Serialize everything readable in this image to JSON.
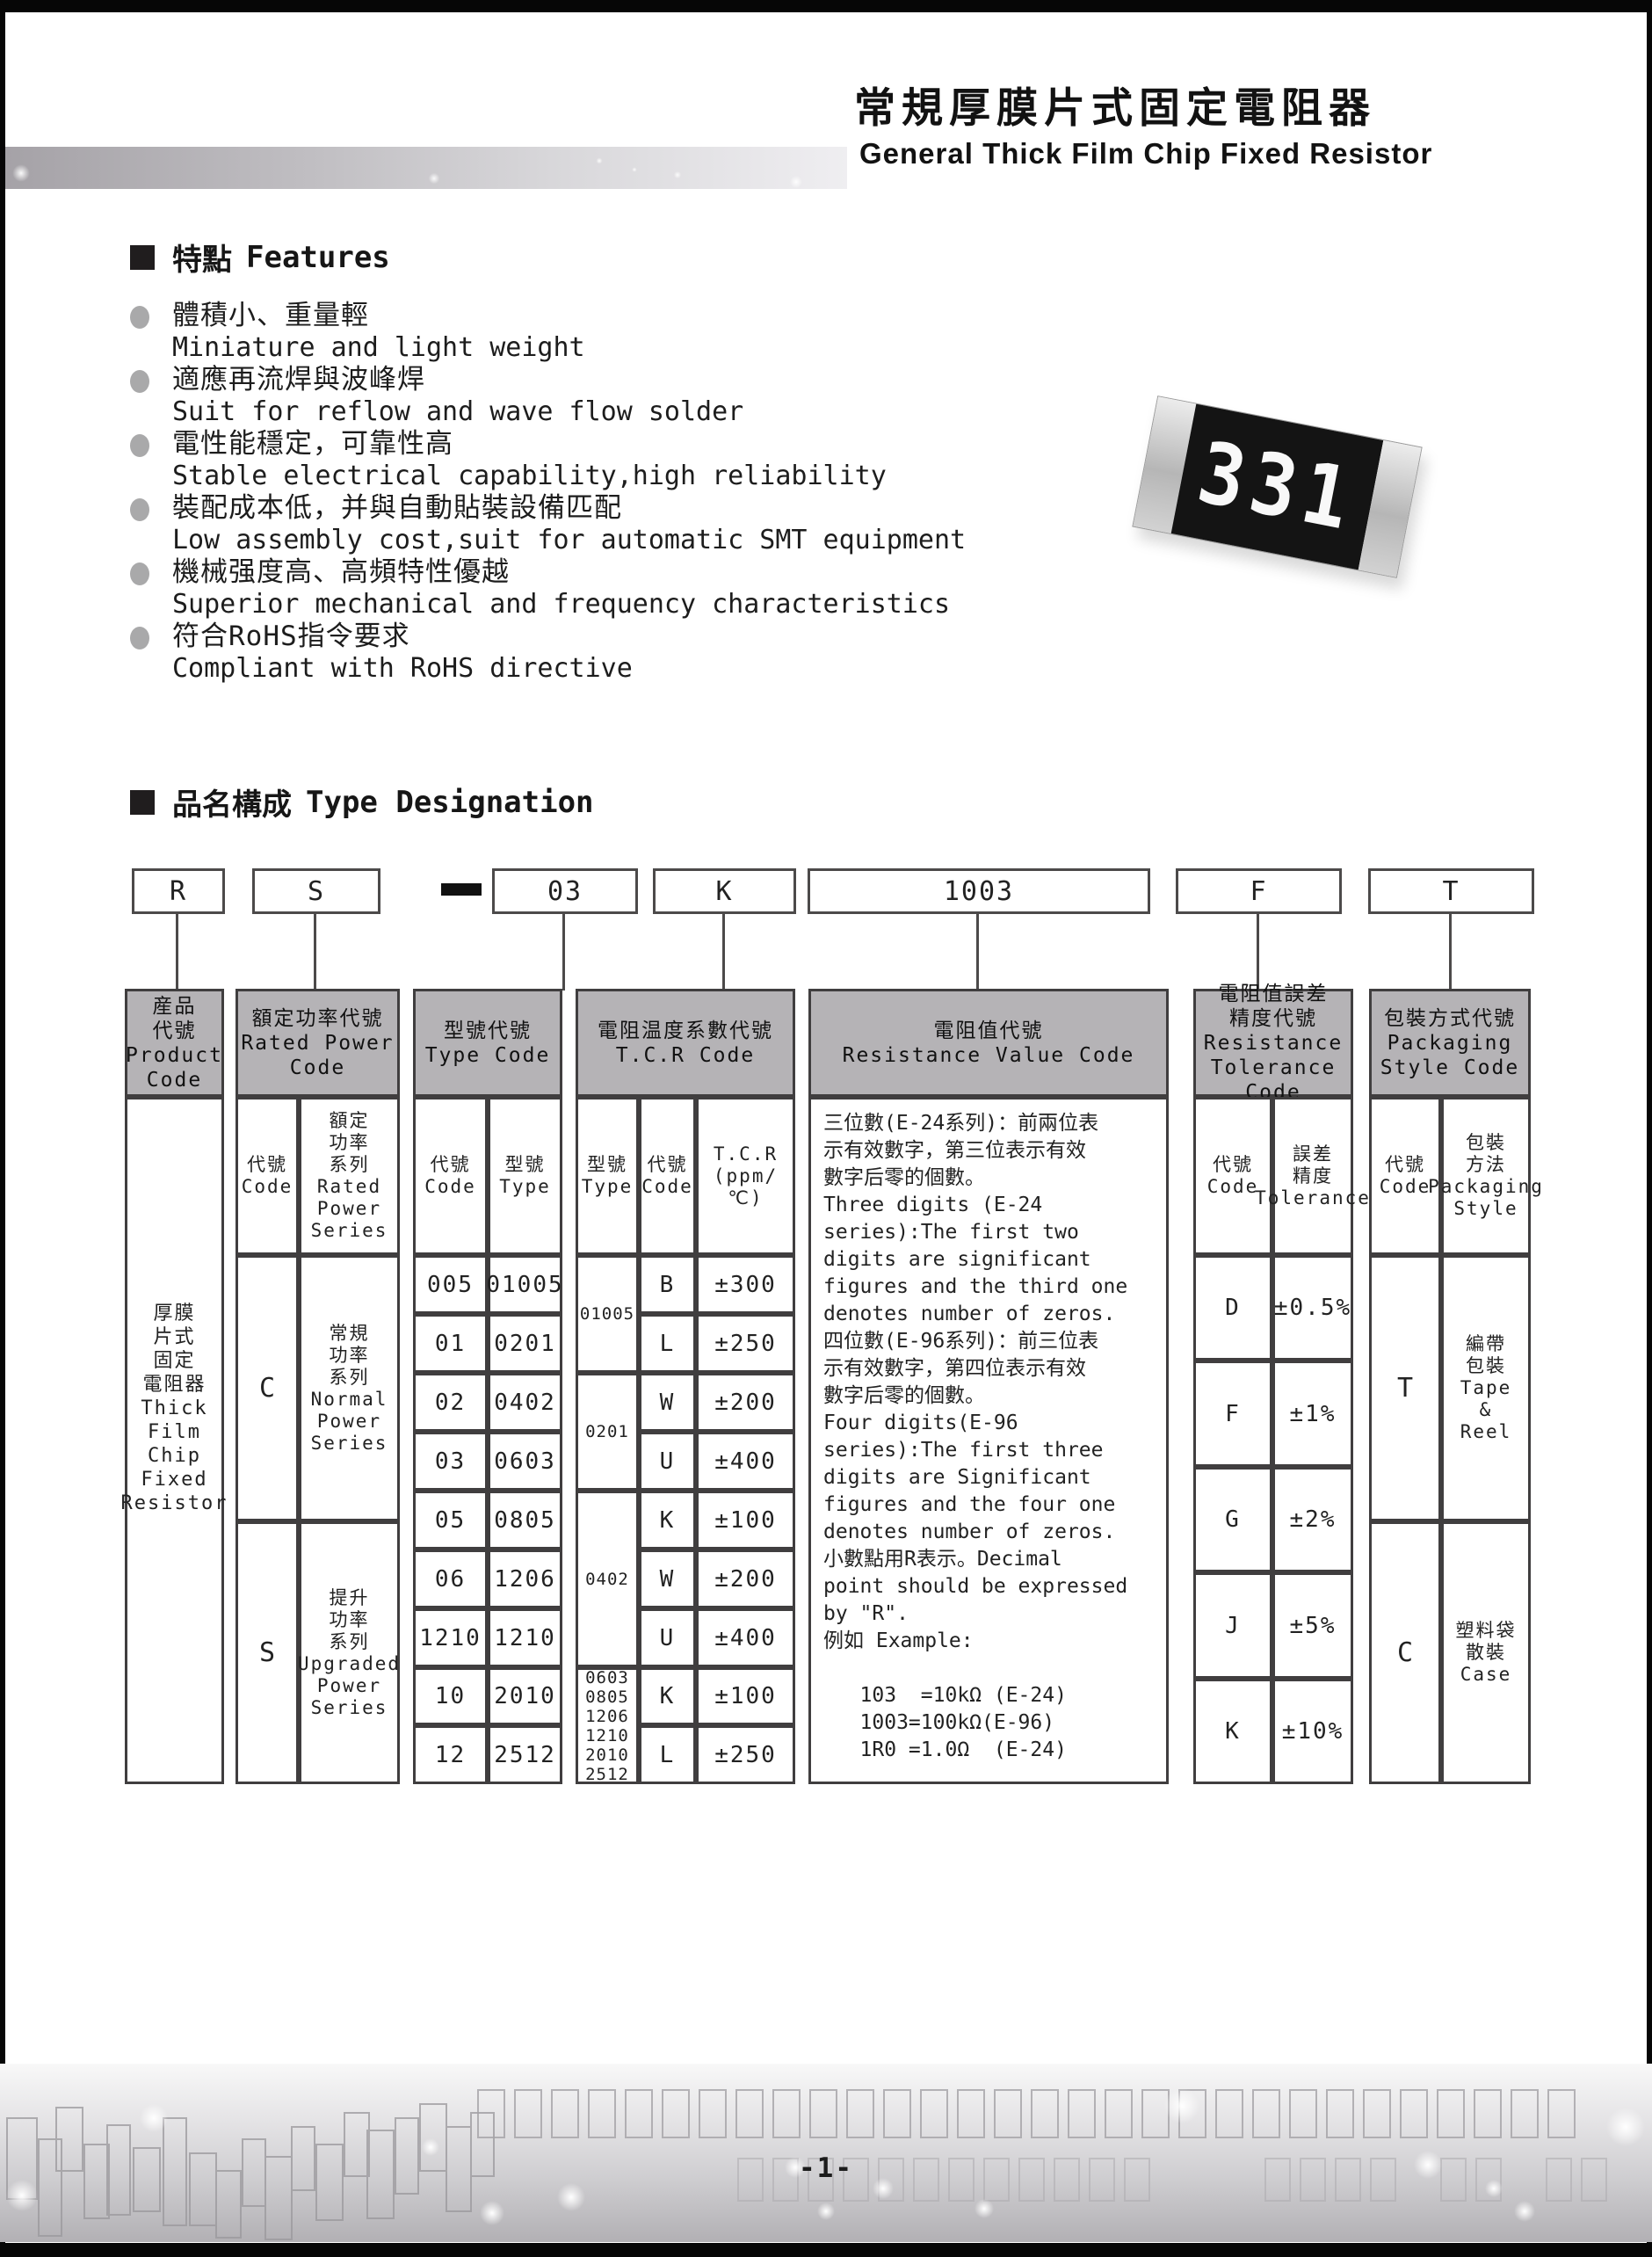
{
  "header": {
    "title_cn": "常規厚膜片式固定電阻器",
    "title_en": "General Thick Film Chip Fixed Resistor"
  },
  "chip": {
    "marking": "331"
  },
  "features": {
    "heading_cn": "特點",
    "heading_en": "Features",
    "items": [
      {
        "cn": "體積小、重量輕",
        "en": "Miniature and light weight"
      },
      {
        "cn": "適應再流焊與波峰焊",
        "en": "Suit for reflow and wave flow solder"
      },
      {
        "cn": "電性能穩定，可靠性高",
        "en": "Stable electrical capability,high reliability"
      },
      {
        "cn": "裝配成本低，并與自動貼裝設備匹配",
        "en": "Low assembly cost,suit for automatic SMT equipment"
      },
      {
        "cn": "機械强度高、高頻特性優越",
        "en": "Superior mechanical and frequency characteristics"
      },
      {
        "cn": "符合RoHS指令要求",
        "en": "Compliant with RoHS directive"
      }
    ]
  },
  "type_designation": {
    "heading_cn": "品名構成",
    "heading_en": "Type Designation",
    "codes": {
      "product": "R",
      "power": "S",
      "separator": "-",
      "type": "03",
      "tcr": "K",
      "resistance": "1003",
      "tolerance": "F",
      "packaging": "T"
    }
  },
  "table": {
    "product": {
      "header": "産品\n代號\nProduct\nCode",
      "body": "厚膜\n片式\n固定\n電阻器\nThick\nFilm\nChip\nFixed\nResistor"
    },
    "rated_power": {
      "header": "額定功率代號\nRated Power\nCode",
      "sub_code": "代號\nCode",
      "sub_series": "額定\n功率\n系列\nRated\nPower\nSeries",
      "rows": [
        {
          "code": "C",
          "series": "常規\n功率\n系列\nNormal\nPower\nSeries"
        },
        {
          "code": "S",
          "series": "提升\n功率\n系列\nUpgraded\nPower\nSeries"
        }
      ]
    },
    "type_code": {
      "header": "型號代號\nType Code",
      "sub_code": "代號\nCode",
      "sub_type": "型號\nType",
      "rows": [
        [
          "005",
          "01005"
        ],
        [
          "01",
          "0201"
        ],
        [
          "02",
          "0402"
        ],
        [
          "03",
          "0603"
        ],
        [
          "05",
          "0805"
        ],
        [
          "06",
          "1206"
        ],
        [
          "1210",
          "1210"
        ],
        [
          "10",
          "2010"
        ],
        [
          "12",
          "2512"
        ]
      ]
    },
    "tcr": {
      "header": "電阻温度系數代號\nT.C.R Code",
      "sub_type": "型號\nType",
      "sub_code": "代號\nCode",
      "sub_value": "T.C.R\n(ppm/℃)",
      "groups": [
        {
          "type": "01005"
        },
        {
          "type": "0201"
        },
        {
          "type": "0402"
        },
        {
          "type": "0603\n0805\n1206\n1210\n2010\n2512"
        }
      ],
      "rows": [
        [
          "B",
          "±300"
        ],
        [
          "L",
          "±250"
        ],
        [
          "W",
          "±200"
        ],
        [
          "U",
          "±400"
        ],
        [
          "K",
          "±100"
        ],
        [
          "W",
          "±200"
        ],
        [
          "U",
          "±400"
        ],
        [
          "K",
          "±100"
        ],
        [
          "L",
          "±250"
        ]
      ]
    },
    "resistance_value": {
      "header": "電阻值代號\nResistance Value Code",
      "body": "三位數(E-24系列)：前兩位表\n示有效數字，第三位表示有效\n數字后零的個數。\nThree digits (E-24\nseries):The first two\ndigits are significant\nfigures and the third one\ndenotes number of zeros.\n四位數(E-96系列)：前三位表\n示有效數字，第四位表示有效\n數字后零的個數。\nFour digits(E-96\nseries):The first three\ndigits are Significant\nfigures and the four one\ndenotes number of zeros.\n小數點用R表示。Decimal\npoint should be expressed\nby \"R\".\n例如 Example:\n\n   103  =10kΩ (E-24)\n   1003=100kΩ(E-96)\n   1R0 =1.0Ω  (E-24)"
    },
    "tolerance": {
      "header": "電阻值誤差\n精度代號\nResistance\nTolerance Code",
      "sub_code": "代號\nCode",
      "sub_value": "誤差\n精度\nTolerance",
      "rows": [
        [
          "D",
          "±0.5%"
        ],
        [
          "F",
          "±1%"
        ],
        [
          "G",
          "±2%"
        ],
        [
          "J",
          "±5%"
        ],
        [
          "K",
          "±10%"
        ]
      ]
    },
    "packaging": {
      "header": "包裝方式代號\nPackaging\nStyle Code",
      "sub_code": "代號\nCode",
      "sub_style": "包裝\n方法\nPackaging\nStyle",
      "rows": [
        {
          "code": "T",
          "style": "編帶\n包裝\nTape\n&\nReel"
        },
        {
          "code": "C",
          "style": "塑料袋\n散裝\nCase"
        }
      ]
    }
  },
  "footer": {
    "page_number": "-1-"
  }
}
